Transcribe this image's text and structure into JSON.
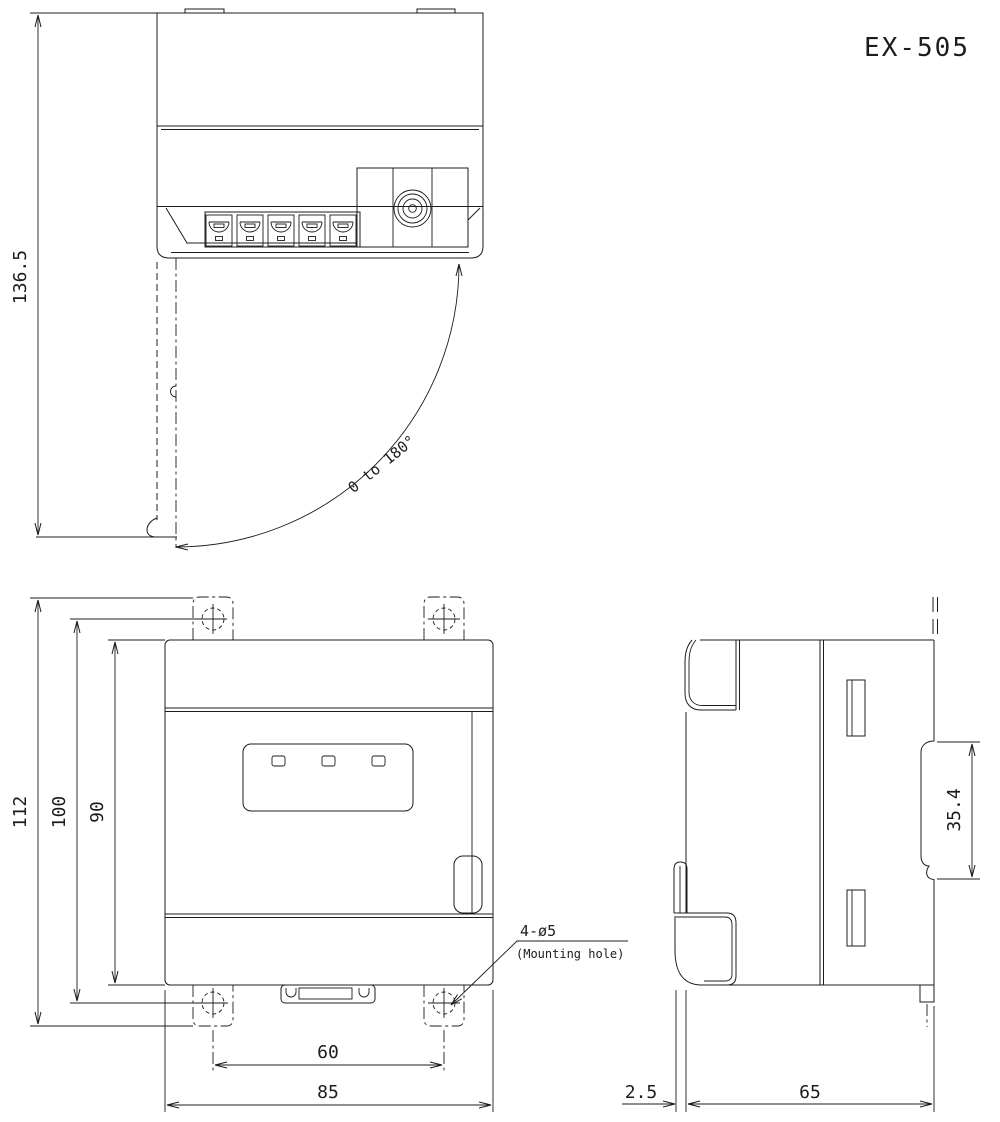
{
  "title": "EX-505",
  "colors": {
    "line": "#1c1c1c",
    "background": "#ffffff"
  },
  "views": {
    "top": {
      "label": "top-view"
    },
    "front": {
      "label": "front-view"
    },
    "side": {
      "label": "side-view"
    }
  },
  "dims": {
    "top_overall_height": "136.5",
    "door_swing": "0 to 180°",
    "front_overall_height": "112",
    "front_hole_pitch_vertical": "100",
    "front_body_height": "90",
    "front_hole_pitch_horizontal": "60",
    "front_body_width": "85",
    "side_din_recess": "35.4",
    "side_front_offset": "2.5",
    "side_depth": "65"
  },
  "annotations": {
    "mounting_hole_spec": "4-ø5",
    "mounting_hole_note": "(Mounting hole)"
  }
}
